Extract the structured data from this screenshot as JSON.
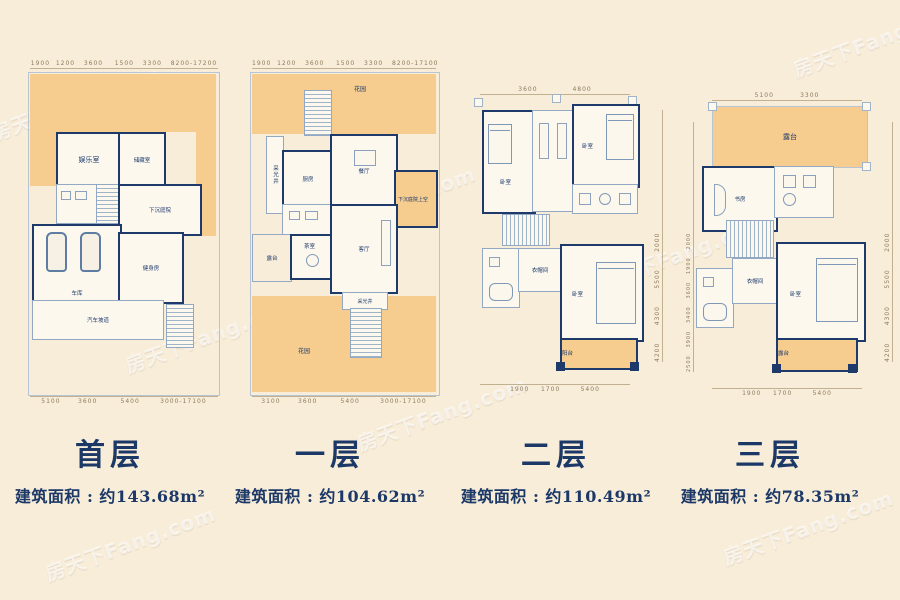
{
  "watermark": "房天下Fang.com",
  "plans": [
    {
      "title": "首层",
      "area": "建筑面积 : 约143.68m²",
      "dims": {
        "top": "1900  1200   3600    1500   3300   8200-17200",
        "bottom": "5100      3600        5400       3000-17100"
      },
      "rooms": {
        "entertainment": "娱乐室",
        "storage": "储藏室",
        "sunken_courtyard": "下沉庭院",
        "garage": "车库",
        "gym": "健身房",
        "ramp": "汽车坡道"
      }
    },
    {
      "title": "一层",
      "area": "建筑面积 : 约104.62m²",
      "dims": {
        "top": "1900  1200   3600    1500   3300   8200-17100",
        "bottom": "3100      3600        5400       3000-17100"
      },
      "rooms": {
        "garden_top": "花园",
        "light_well": "采光井",
        "kitchen": "厨房",
        "dining": "餐厅",
        "terrace": "露台",
        "tea_room": "茶室",
        "living": "客厅",
        "sunken_above": "下沉庭院上空",
        "light_well2": "采光井",
        "garden_bottom": "花园"
      }
    },
    {
      "title": "二层",
      "area": "建筑面积 : 约110.49m²",
      "dims": {
        "top": "3600            4800",
        "bottom": "1900    1700       5400",
        "right": "4200      4300      5500      2000"
      },
      "rooms": {
        "bedroom1": "卧室",
        "bedroom2": "卧室",
        "closet": "衣帽间",
        "bedroom3": "卧室",
        "balcony": "阳台"
      }
    },
    {
      "title": "三层",
      "area": "建筑面积 : 约78.35m²",
      "dims": {
        "top": "5100         3300",
        "bottom": "1900    1700       5400",
        "left": "2500   3900   3400   3600   1900   2000",
        "right": "4200      4300      5500      2000"
      },
      "rooms": {
        "roof_terrace": "露台",
        "study": "书房",
        "closet": "衣帽间",
        "bedroom": "卧室",
        "terrace2": "露台"
      }
    }
  ]
}
